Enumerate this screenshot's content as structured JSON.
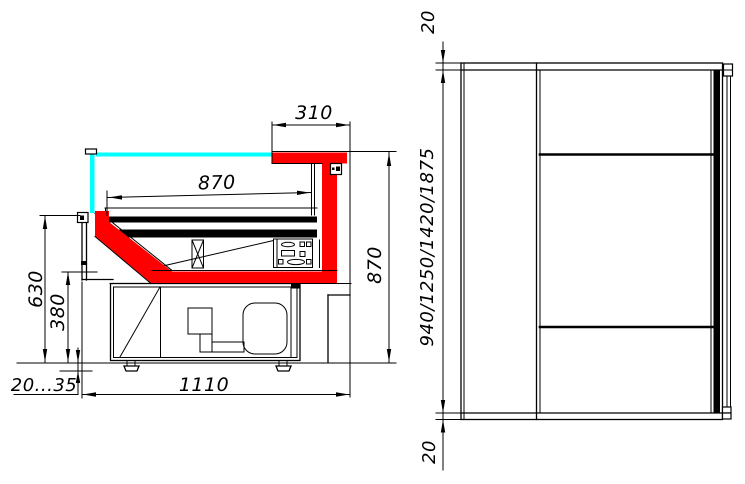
{
  "drawing": {
    "title": "refrigerated-display-case-dimension-drawing",
    "background": "#ffffff",
    "line_color": "#000000",
    "profile_color": "#ff0000",
    "glass_color": "#00ffff",
    "section_view": {
      "dim_canopy_overhang": "310",
      "dim_well_depth": "870",
      "dim_front_height": "630",
      "dim_base_height": "380",
      "dim_leg_adjust": "20...35",
      "dim_overall_depth": "1110",
      "dim_overall_height": "870"
    },
    "plan_view": {
      "dim_top_overhang": "20",
      "dim_length_options": "940/1250/1420/1875",
      "dim_bottom_overhang": "20"
    }
  }
}
